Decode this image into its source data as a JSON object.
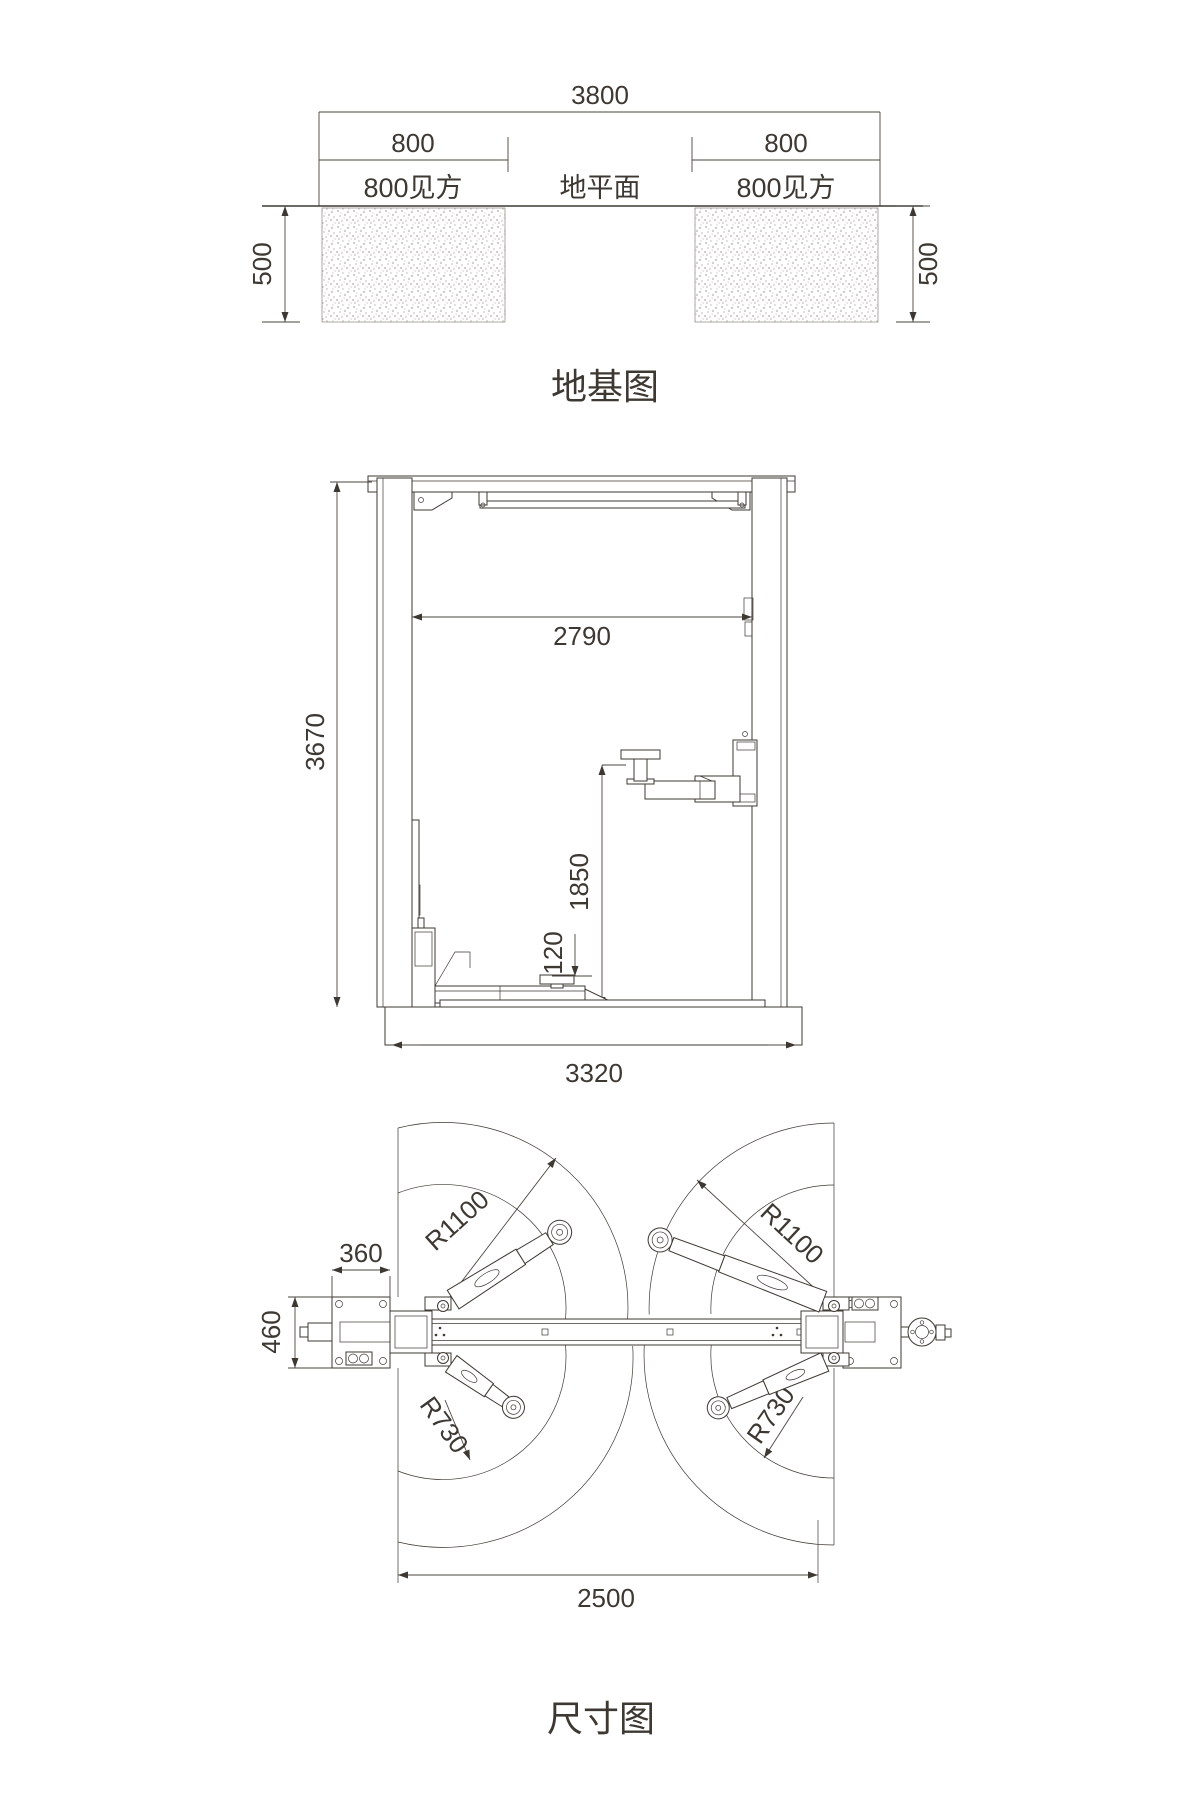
{
  "drawing": {
    "line_color": "#3e3833",
    "foundation_view": {
      "title": "地基图",
      "overall_width": "3800",
      "left_pit_width": "800",
      "right_pit_width": "800",
      "left_pit_label": "800见方",
      "ground_label": "地平面",
      "right_pit_label": "800见方",
      "left_pit_depth": "500",
      "right_pit_depth": "500"
    },
    "front_view": {
      "overall_height": "3670",
      "clear_width": "2790",
      "lift_height": "1850",
      "min_pad_height": "120",
      "base_width": "3320"
    },
    "plan_view": {
      "title": "尺寸图",
      "column_depth_offset": "360",
      "column_width": "460",
      "left_long_arm_radius": "R1100",
      "right_long_arm_radius": "R1100",
      "left_short_arm_radius": "R730",
      "right_short_arm_radius": "R730",
      "drive_through_width": "2500"
    }
  }
}
